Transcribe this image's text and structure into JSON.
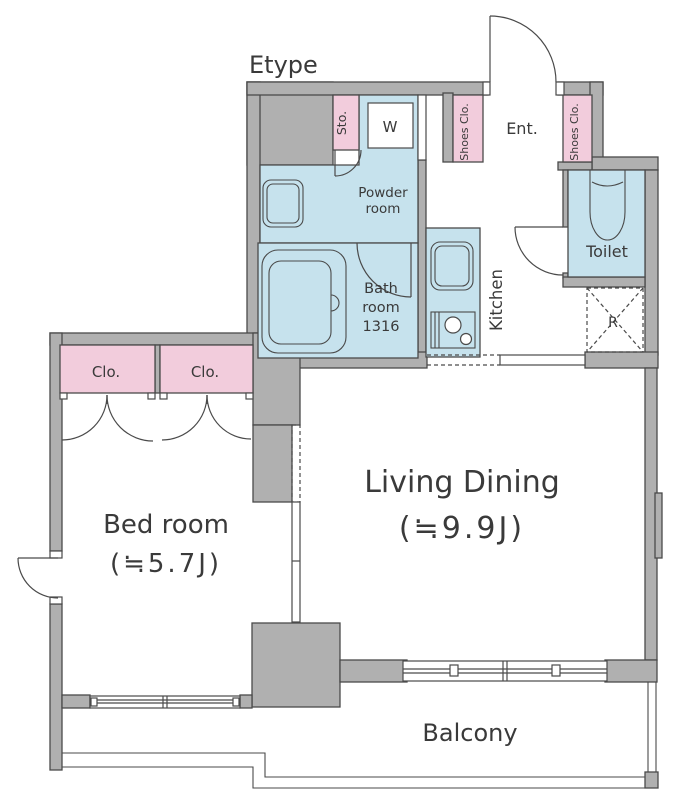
{
  "title": "Etype",
  "colors": {
    "wall": "#B0B0B0",
    "outline": "#4A4A4A",
    "accent_pink": "#F2CCDC",
    "accent_blue": "#C6E2ED",
    "text": "#3A3A3A"
  },
  "rooms": {
    "living": {
      "name": "Living Dining",
      "size": "(≒9.9J)"
    },
    "bedroom": {
      "name": "Bed room",
      "size": "(≒5.7J)"
    },
    "balcony": {
      "name": "Balcony"
    },
    "kitchen": {
      "name": "Kitchen"
    },
    "toilet": {
      "name": "Toilet"
    },
    "bathroom": {
      "line1": "Bath",
      "line2": "room",
      "line3": "1316"
    },
    "powder_room": {
      "line1": "Powder",
      "line2": "room"
    },
    "entrance": {
      "name": "Ent."
    },
    "storage": {
      "name": "Sto."
    },
    "shoes_closet_left": {
      "name": "Shoes Clo."
    },
    "shoes_closet_right": {
      "name": "Shoes Clo."
    },
    "closet_left": {
      "name": "Clo."
    },
    "closet_right": {
      "name": "Clo."
    },
    "washer": {
      "name": "W"
    },
    "refrigerator": {
      "name": "R"
    }
  }
}
